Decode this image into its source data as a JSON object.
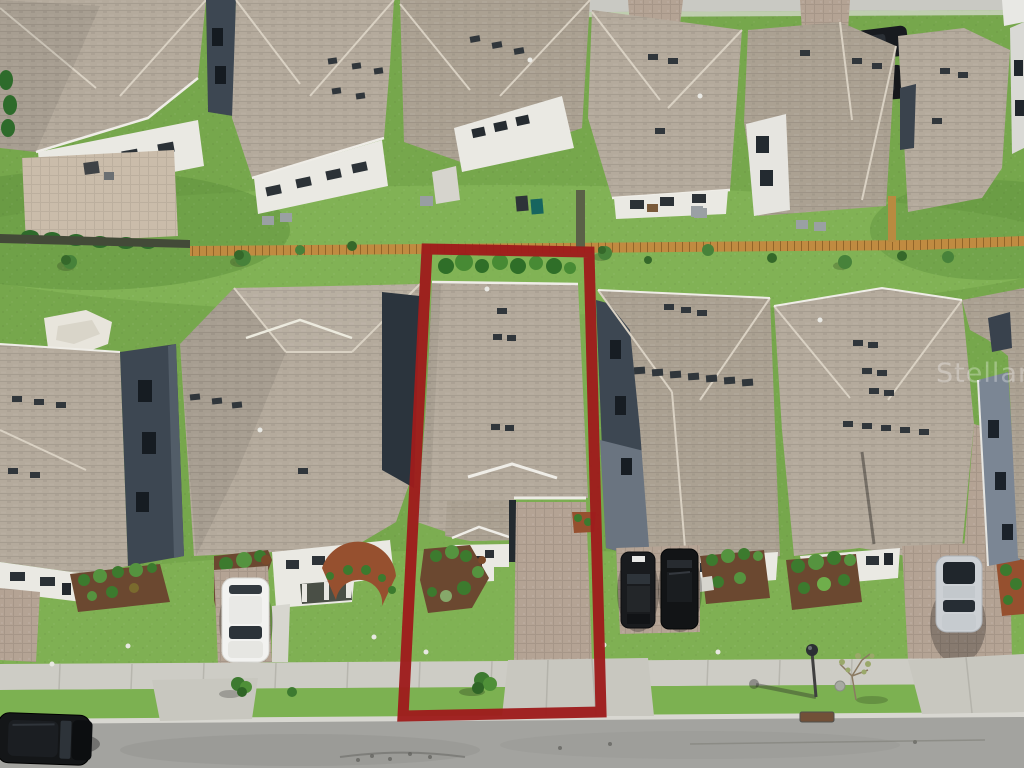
{
  "scene": {
    "type": "aerial-photo",
    "description": "Overhead drone view of a suburban street of single-family homes with tan shingle roofs; the subject lot in the center is outlined with a thick dark-red boundary.",
    "top_row_house_count": 6,
    "front_row_house_count": 6
  },
  "watermark": {
    "text": "Stellar"
  },
  "highlight": {
    "label": "subject-lot-boundary",
    "points": "427,249 589,252 601,712 403,716",
    "color": "#9e1c1c",
    "stroke_width": 11
  },
  "vehicles": [
    {
      "name": "white-suv",
      "color": "#f2f2f0",
      "location": "left driveway"
    },
    {
      "name": "black-car-1",
      "color": "#191b1e",
      "location": "right-center driveway"
    },
    {
      "name": "black-car-2",
      "color": "#121416",
      "location": "right-center driveway"
    },
    {
      "name": "silver-suv",
      "color": "#ccd0d4",
      "location": "right driveway"
    },
    {
      "name": "black-suv-street",
      "color": "#121416",
      "location": "parked on street bottom-left"
    },
    {
      "name": "dark-car-top",
      "color": "#1c1f22",
      "location": "top backyard"
    },
    {
      "name": "dark-truck-top",
      "color": "#181b1f",
      "location": "top right driveway"
    }
  ],
  "palette": {
    "grass": "#76a74c",
    "grass_light": "#8cbd5d",
    "grass_dark": "#5d8f3c",
    "roof_a": "#b4aa9c",
    "roof_b": "#aba192",
    "wall_white": "#eae9e3",
    "wall_dark": "#3d4752",
    "street": "#a3a39f",
    "sidewalk": "#cdccc5",
    "concrete": "#c8c7bf",
    "paver": "#b4a394",
    "mulch": "#6b4830",
    "mulch_red": "#96502f",
    "shrub": "#3c7a2e",
    "fence": "#c08b41",
    "highlight": "#9e1c1c",
    "car_white": "#f2f2f0",
    "car_black": "#141618",
    "car_silver": "#ccd0d4"
  }
}
